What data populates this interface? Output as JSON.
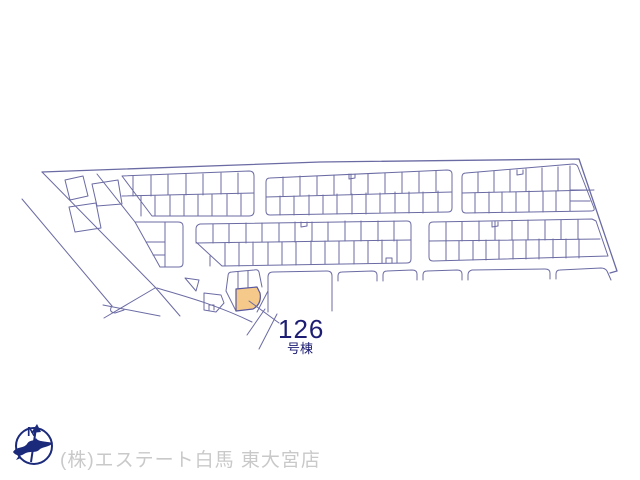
{
  "plan": {
    "title": "site-plan",
    "unit_number": "126",
    "unit_suffix": "号棟",
    "company": "(株)エステート白馬 東大宮店",
    "compass_label": "N",
    "colors": {
      "line": "#6b6ba4",
      "highlight_fill": "#f5c98a",
      "label_text": "#1d1d73",
      "company_text": "#c9c9c9",
      "compass": "#1b2a7a",
      "bg": "#ffffff"
    }
  }
}
